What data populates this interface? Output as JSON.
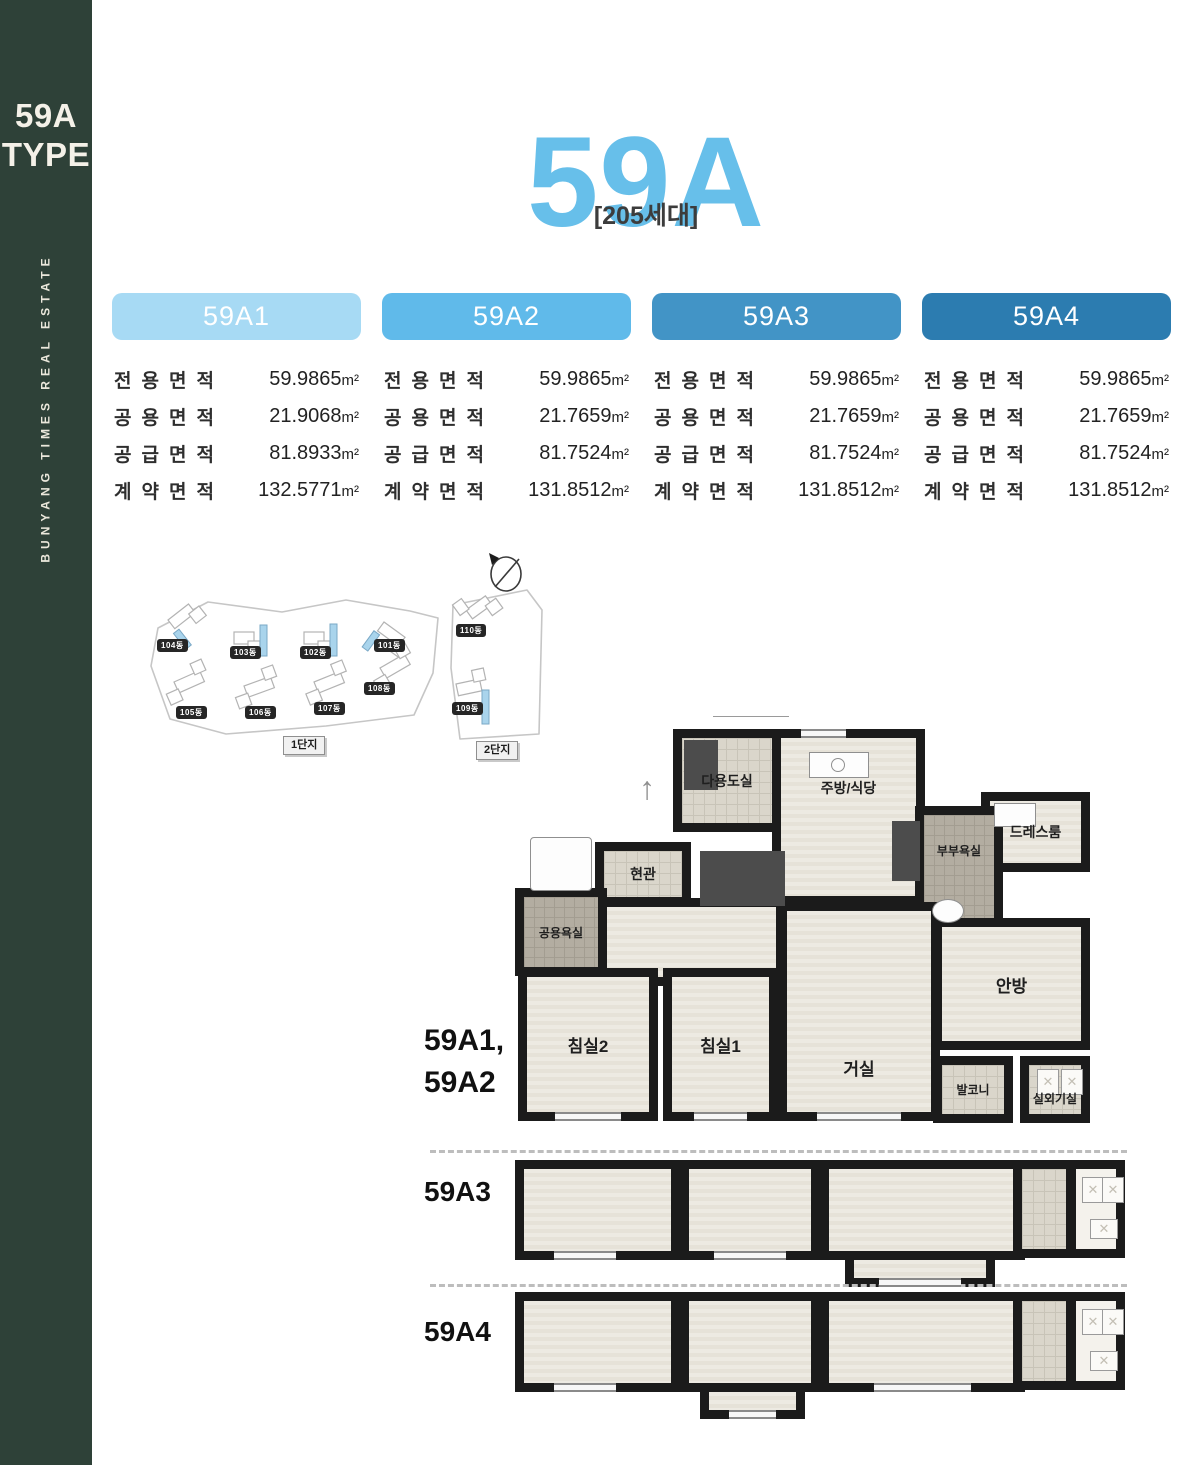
{
  "colors": {
    "sidebar_bg": "#2e4138",
    "title_blue": "#67bfea",
    "pill_59a1": "#a7daf4",
    "pill_59a2": "#60baea",
    "pill_59a3": "#4294c6",
    "pill_59a4": "#2c7cb0"
  },
  "sidebar": {
    "type_line1": "59A",
    "type_line2": "TYPE",
    "vertical_text": "BUNYANG TIMES REAL ESTATE"
  },
  "header": {
    "title": "59A",
    "subtitle": "[205세대]"
  },
  "area_table": {
    "row_labels": [
      "전용면적",
      "공용면적",
      "공급면적",
      "계약면적"
    ],
    "unit": "m²",
    "variants": [
      {
        "name": "59A1",
        "values": [
          "59.9865",
          "21.9068",
          "81.8933",
          "132.5771"
        ]
      },
      {
        "name": "59A2",
        "values": [
          "59.9865",
          "21.7659",
          "81.7524",
          "131.8512"
        ]
      },
      {
        "name": "59A3",
        "values": [
          "59.9865",
          "21.7659",
          "81.7524",
          "131.8512"
        ]
      },
      {
        "name": "59A4",
        "values": [
          "59.9865",
          "21.7659",
          "81.7524",
          "131.8512"
        ]
      }
    ]
  },
  "site_plan": {
    "complex1": {
      "label": "1단지",
      "buildings": [
        "104동",
        "103동",
        "102동",
        "101동",
        "105동",
        "106동",
        "107동",
        "108동"
      ]
    },
    "complex2": {
      "label": "2단지",
      "buildings": [
        "110동",
        "109동"
      ]
    }
  },
  "floor_plan": {
    "main_label_line1": "59A1,",
    "main_label_line2": "59A2",
    "variant3_label": "59A3",
    "variant4_label": "59A4",
    "rooms": {
      "utility": "다용도실",
      "kitchen": "주방/식당",
      "dress_room": "드레스룸",
      "master_bath": "부부욕실",
      "entrance": "현관",
      "common_bath": "공용욕실",
      "bedroom2": "침실2",
      "bedroom1": "침실1",
      "living": "거실",
      "master_bedroom": "안방",
      "balcony": "발코니",
      "ac_room": "실외기실"
    }
  }
}
